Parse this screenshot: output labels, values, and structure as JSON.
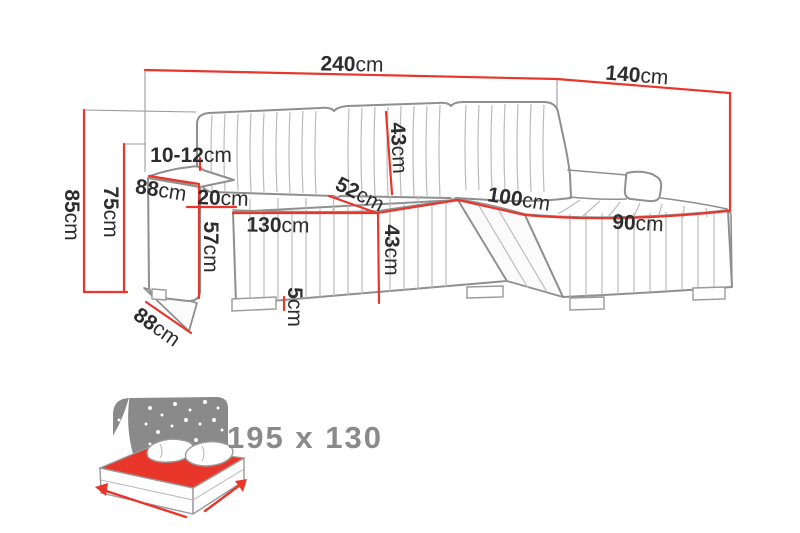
{
  "colors": {
    "dimension_red": "#e8362b",
    "outline_gray": "#8f8f8f",
    "channel_gray": "#bcbcbc",
    "label_text_dark": "#2d2d2d",
    "icon_gray": "#8a8a8a"
  },
  "icons": {
    "sleeping_function": "sofa-bed-with-mattress-icon"
  },
  "sofa_dimensions": {
    "total_width": {
      "num": "240",
      "unit": "cm"
    },
    "chaise_total_depth": {
      "num": "140",
      "unit": "cm"
    },
    "total_height": {
      "num": "85",
      "unit": "cm"
    },
    "backrest_height": {
      "num": "75",
      "unit": "cm"
    },
    "armrest_top_thickness": {
      "num": "10-12",
      "unit": "cm"
    },
    "armrest_depth": {
      "num": "88",
      "unit": "cm"
    },
    "armrest_width": {
      "num": "20",
      "unit": "cm"
    },
    "armrest_side_height": {
      "num": "57",
      "unit": "cm"
    },
    "seat_width": {
      "num": "130",
      "unit": "cm"
    },
    "seat_depth": {
      "num": "52",
      "unit": "cm"
    },
    "backrest_cushion_height": {
      "num": "43",
      "unit": "cm"
    },
    "seat_front_height": {
      "num": "43",
      "unit": "cm"
    },
    "leg_height": {
      "num": "5",
      "unit": "cm"
    },
    "chaise_seat_length": {
      "num": "100",
      "unit": "cm"
    },
    "chaise_width": {
      "num": "90",
      "unit": "cm"
    },
    "base_depth": {
      "num": "88",
      "unit": "cm"
    }
  },
  "sleeping_area": {
    "label": "195 x 130"
  }
}
